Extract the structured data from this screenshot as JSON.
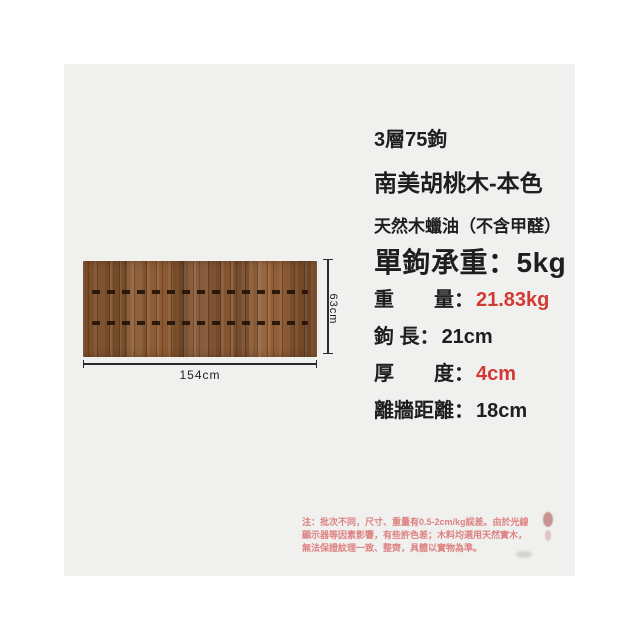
{
  "figure": {
    "width_label": "154cm",
    "height_label": "63cm"
  },
  "header": {
    "hook_count": "3層75鉤",
    "material": "南美胡桃木-本色",
    "finish": "天然木蠟油（不含甲醛）",
    "hook_capacity": "單鉤承重：5kg"
  },
  "specs": [
    {
      "label": "重　　量：",
      "value": "21.83kg",
      "value_color": "#d43a34"
    },
    {
      "label": "鉤 長：",
      "value": "21cm",
      "value_color": "#1e1e1e"
    },
    {
      "label": "厚　　度：",
      "value": "4cm",
      "value_color": "#d43a34"
    },
    {
      "label": "離牆距離：",
      "value": "18cm",
      "value_color": "#1e1e1e"
    }
  ],
  "note": {
    "line1": "注：批次不同，尺寸、重量有0.5-2cm/kg誤差。由於光線",
    "line2": "顯示器等因素影響，有些許色差；木料均選用天然實木，",
    "line3": "無法保證紋理一致、整齊，具體以實物為準。"
  },
  "colors": {
    "accent_red": "#d43a34",
    "text_black": "#1e1e1e",
    "note_pink": "#de8181",
    "panel_bg": "#f0f0ef",
    "wood_base": "#85552f"
  }
}
